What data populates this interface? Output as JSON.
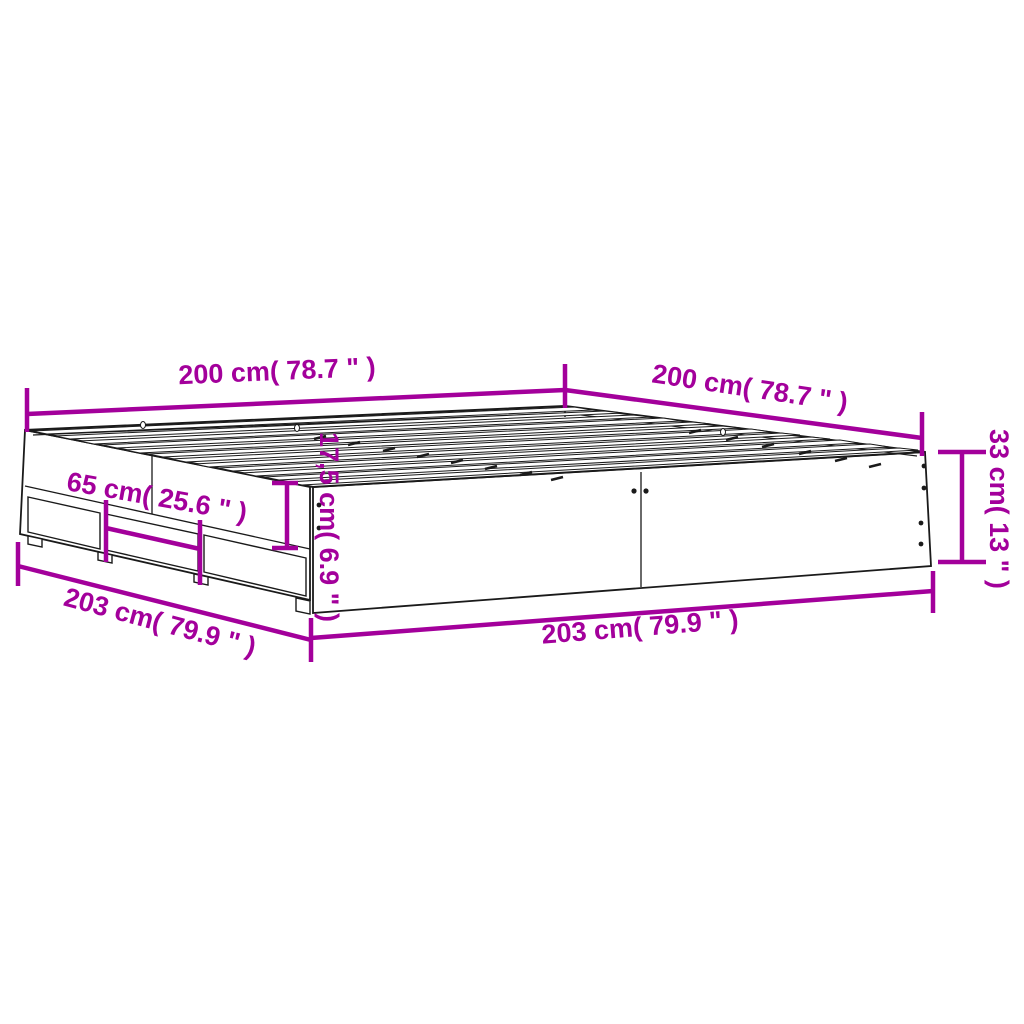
{
  "diagram": {
    "kind": "product-dimension-diagram",
    "subject": "bed-frame-with-drawers",
    "colors": {
      "accent": "#A3009B",
      "line": "#1A1A1A",
      "background": "#FFFFFF"
    },
    "labels": {
      "width_top_left": "200 cm( 78.7 \" )",
      "depth_top_right": "200 cm( 78.7 \" )",
      "height_right": "33 cm( 13 \" )",
      "rail_height_center": "17,5 cm( 6.9 \" )",
      "drawer_width_left": "65 cm( 25.6 \" )",
      "length_bottom_left": "203 cm( 79.9 \" )",
      "length_bottom_front": "203 cm( 79.9 \" )"
    }
  }
}
